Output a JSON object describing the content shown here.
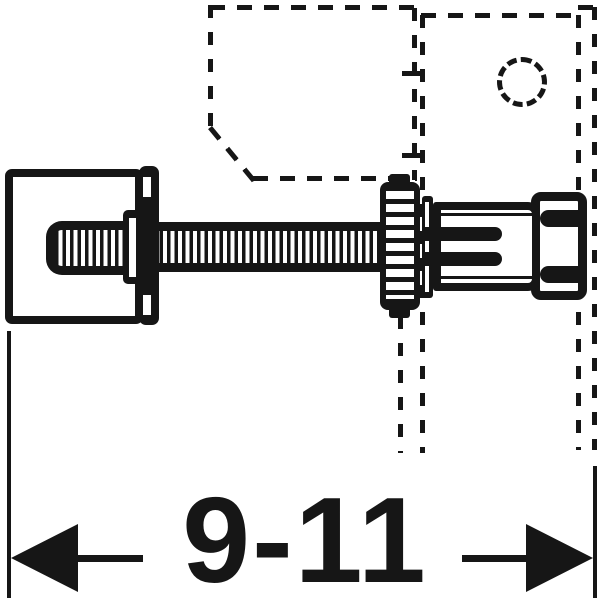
{
  "diagram": {
    "type": "technical-installation-drawing",
    "dimension": {
      "label": "9-11"
    },
    "colors": {
      "ink": "#161616",
      "background": "#ffffff"
    },
    "parts": [
      "wall-bracket-plate",
      "threaded-rod",
      "knurled-adjustment-nut",
      "washer",
      "anchor-sleeve-with-prongs",
      "frame-end-cap",
      "stud-profile-dashed-outline",
      "panel-dashed-outline",
      "pipe-hole-dashed-circle"
    ]
  }
}
